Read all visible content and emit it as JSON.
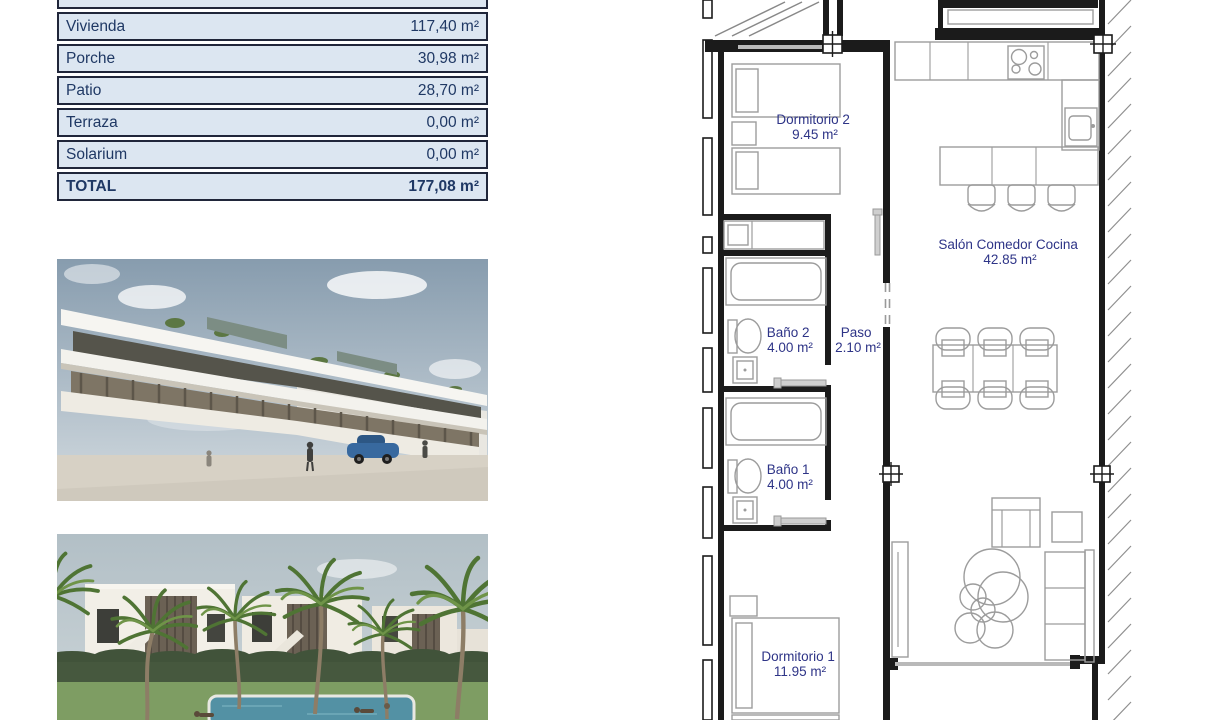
{
  "colors": {
    "table_row_bg": "#dce6f1",
    "table_text": "#1f3864",
    "table_border": "#20263a",
    "plan_label": "#2e3487",
    "plan_wall": "#1b1b1b",
    "plan_furniture": "#9c9c9c"
  },
  "surface_table": {
    "rows": [
      {
        "label": "Vivienda",
        "value": "117,40 m²"
      },
      {
        "label": "Porche",
        "value": "30,98 m²"
      },
      {
        "label": "Patio",
        "value": "28,70 m²"
      },
      {
        "label": "Terraza",
        "value": "0,00 m²"
      },
      {
        "label": "Solarium",
        "value": "0,00 m²"
      }
    ],
    "total": {
      "label": "TOTAL",
      "value": "177,08 m²"
    }
  },
  "floor_plan": {
    "rooms": [
      {
        "name": "Dormitorio 2",
        "area": "9.45 m²"
      },
      {
        "name": "Salón Comedor Cocina",
        "area": "42.85 m²"
      },
      {
        "name": "Baño 2",
        "area": "4.00 m²"
      },
      {
        "name": "Paso",
        "area": "2.10 m²"
      },
      {
        "name": "Baño 1",
        "area": "4.00 m²"
      },
      {
        "name": "Dormitorio 1",
        "area": "11.95 m²"
      }
    ]
  }
}
